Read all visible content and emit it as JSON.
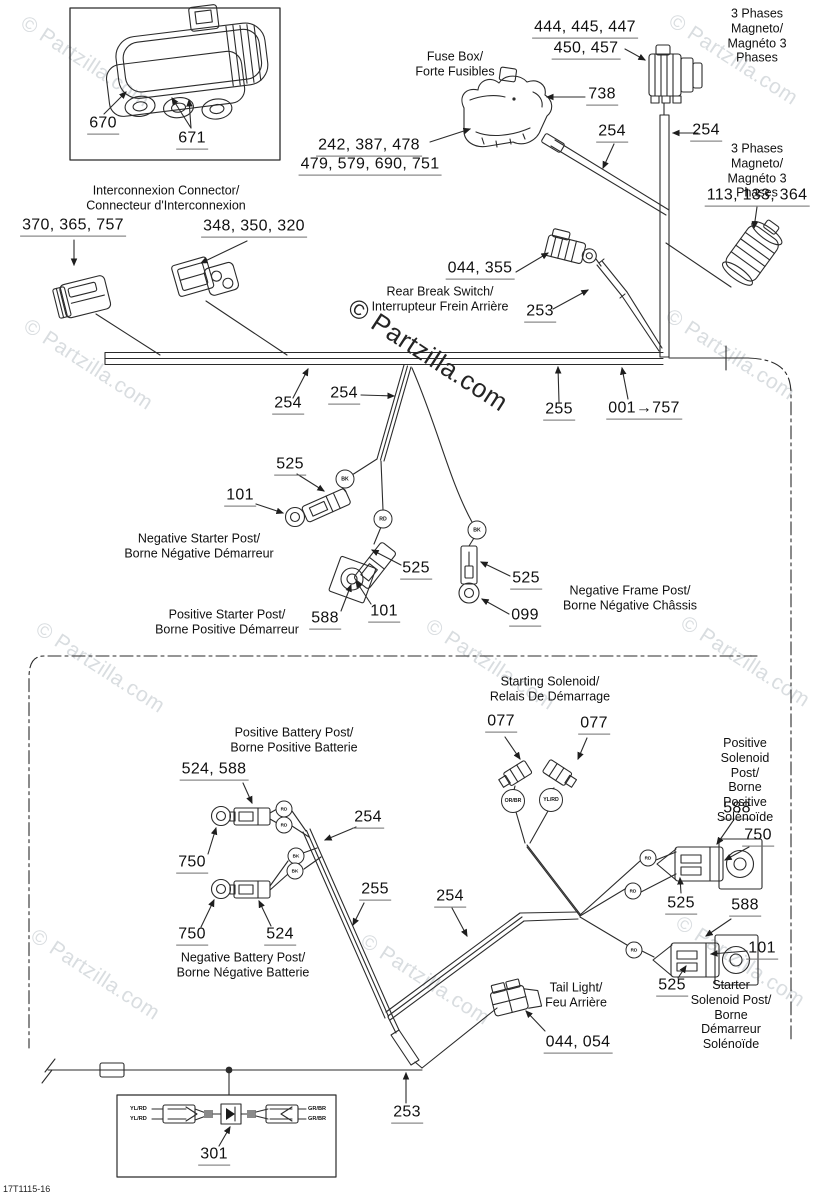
{
  "watermark": "© Partzilla.com",
  "doc_code": "17T1115-16",
  "wire_colors": {
    "bk": "BK",
    "rd": "RD",
    "or_br": "OR/BR",
    "yl_rd": "YL/RD",
    "gr_br": "GR/BR"
  },
  "labels": {
    "ic_670": "670",
    "ic_671": "671",
    "interconnect_name": "Interconnexion Connector/\nConnecteur d'Interconnexion",
    "r370": "370, 365, 757",
    "r348": "348, 350, 320",
    "fuse_box_name": "Fuse Box/\nForte Fusibles",
    "r444": "444, 445, 447",
    "r450": "450, 457",
    "r738": "738",
    "r242": "242, 387, 478",
    "r479": "479, 579, 690, 751",
    "magneto_top_name": "3 Phases Magneto/\nMagnéto 3 Phases",
    "magneto_right_name": "3 Phases Magneto/\nMagnéto 3 Phases",
    "r113": "113, 133, 364",
    "r254_fuse": "254",
    "r254_mag": "254",
    "r044_355": "044, 355",
    "brake_switch_name": "Rear Break Switch/\nInterrupteur Frein Arrière",
    "r253_brake": "253",
    "r254_bar": "254",
    "r254_branch": "254",
    "r255_bar": "255",
    "r001_757": "001→757",
    "r525_negstart": "525",
    "r101_negstart": "101",
    "neg_starter_name": "Negative Starter Post/\nBorne Négative Démarreur",
    "r525_posstart": "525",
    "r588_posstart": "588",
    "r101_posstart": "101",
    "pos_starter_name": "Positive Starter Post/\nBorne Positive Démarreur",
    "r525_frame": "525",
    "r099": "099",
    "neg_frame_name": "Negative Frame Post/\nBorne Négative Châssis",
    "solenoid_name": "Starting Solenoid/\nRelais De Démarrage",
    "r077_a": "077",
    "r077_b": "077",
    "pos_batt_name": "Positive Battery Post/\nBorne Positive Batterie",
    "r524_588": "524, 588",
    "r750_posbatt": "750",
    "r254_lower": "254",
    "r255_lower": "255",
    "r254_mid": "254",
    "pos_sol_name": "Positive Solenoid Post/\nBorne Positive Solénoïde",
    "r588_possol": "588",
    "r750_possol": "750",
    "r525_possol": "525",
    "r588_startsol": "588",
    "r101_startsol": "101",
    "r525_startsol": "525",
    "start_sol_name": "Starter Solenoid Post/\nBorne Démarreur Solénoïde",
    "r750_negbatt": "750",
    "r524_negbatt": "524",
    "neg_batt_name": "Negative Battery Post/\nBorne Négative Batterie",
    "tail_light_name": "Tail Light/\nFeu Arrière",
    "r044_054": "044, 054",
    "r253_tail": "253",
    "r301": "301"
  }
}
